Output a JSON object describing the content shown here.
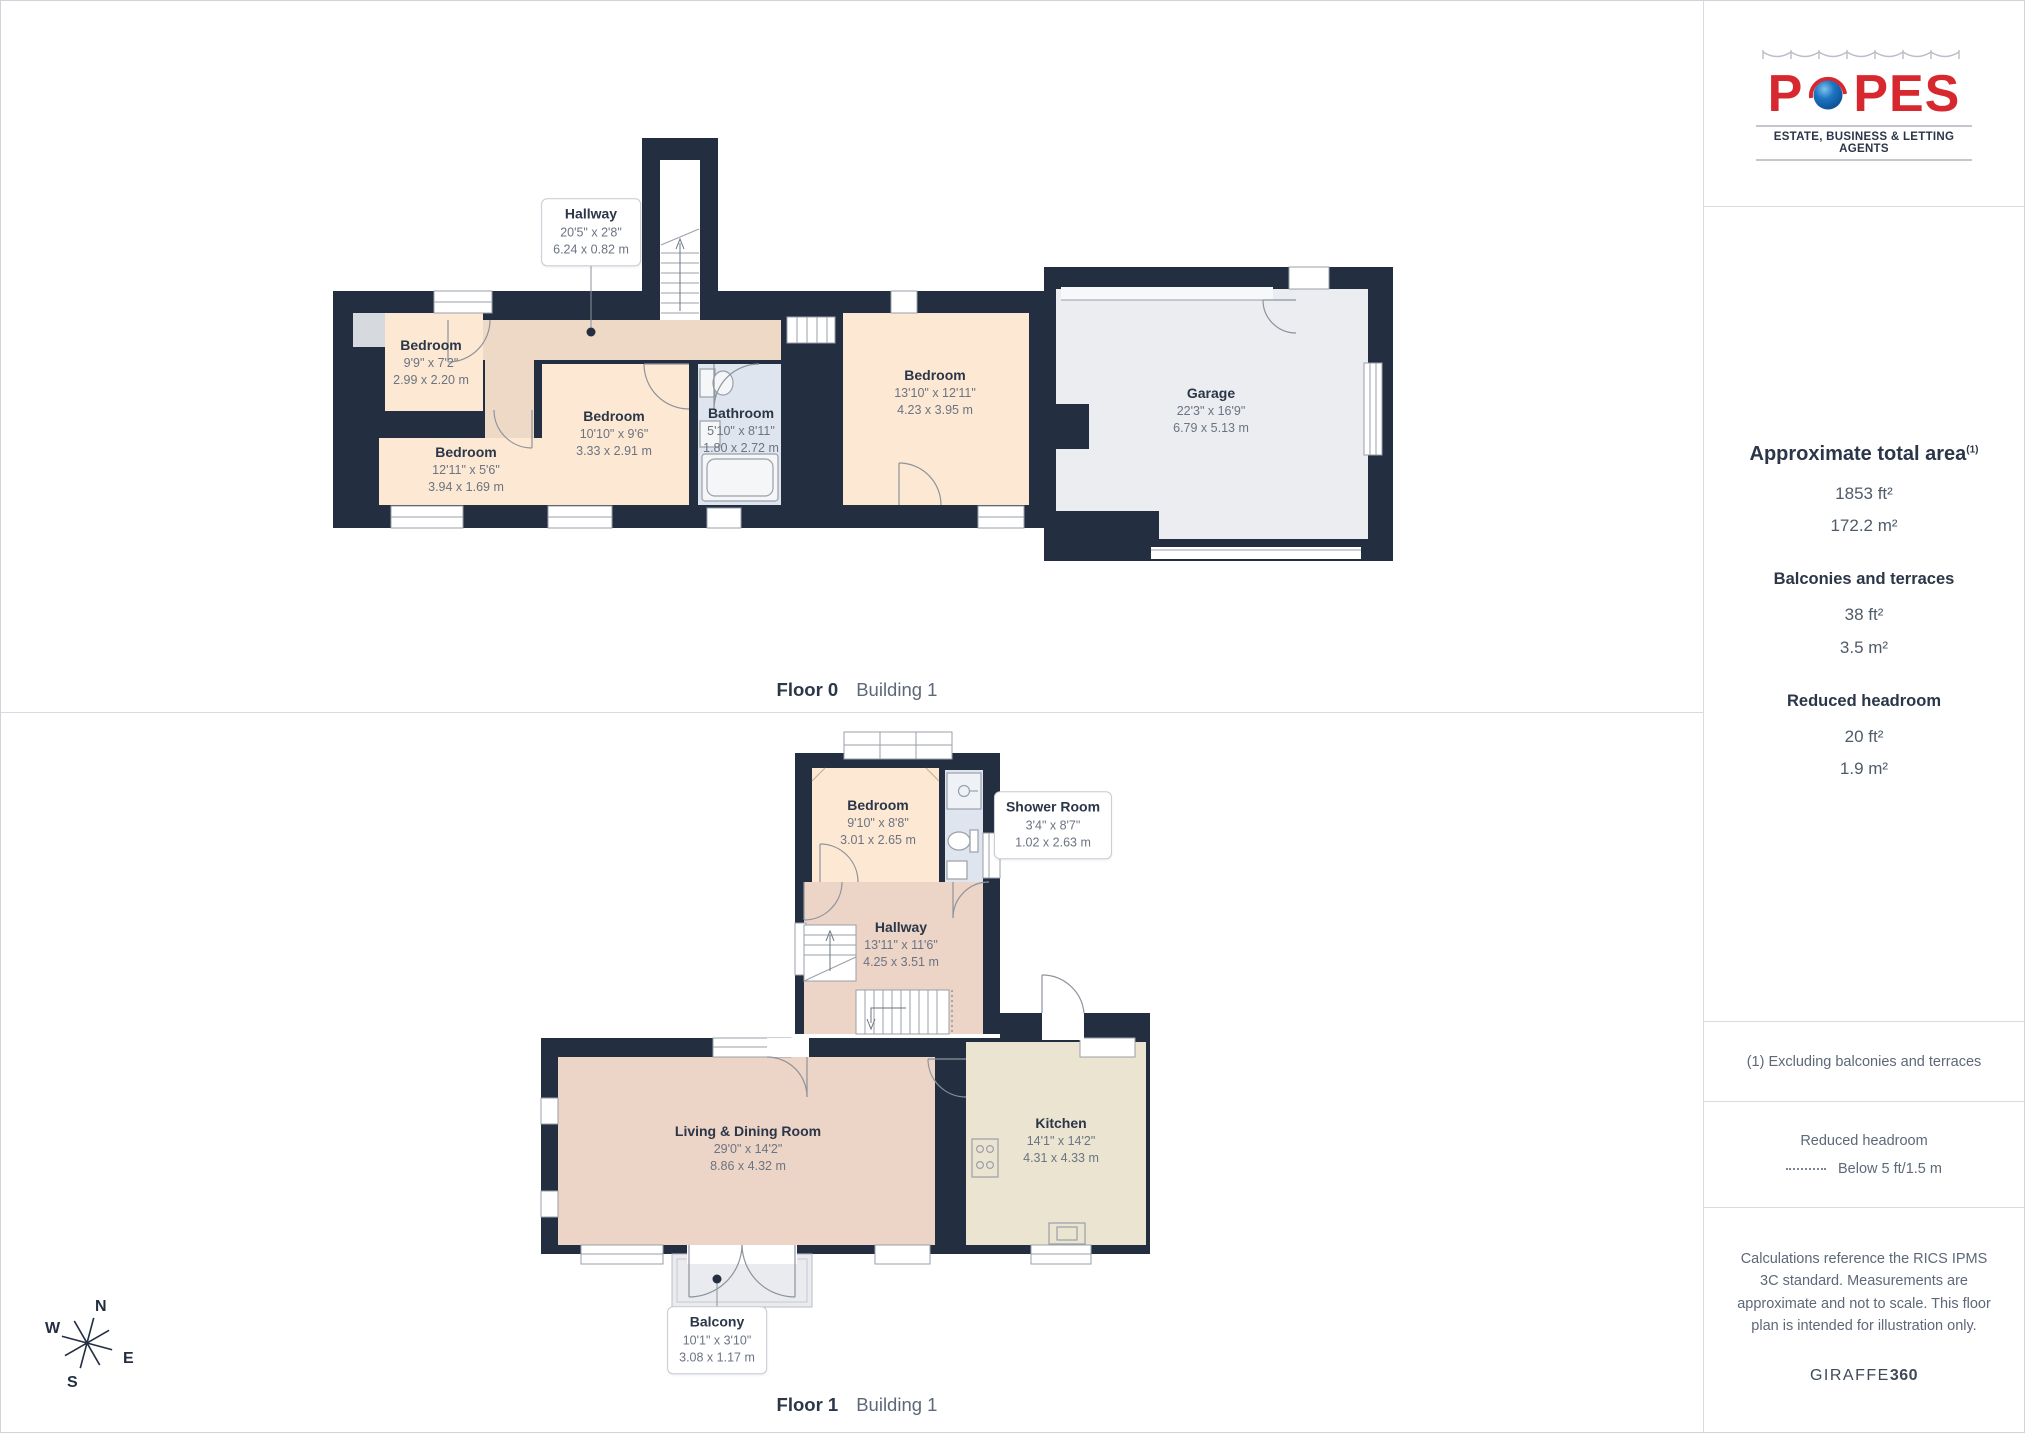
{
  "branding": {
    "logo_letters_before": "P",
    "logo_letters_after": "PES",
    "tagline": "ESTATE, BUSINESS & LETTING AGENTS"
  },
  "sidebar": {
    "total_area_title": "Approximate total area",
    "total_area_sup": "(1)",
    "total_area_ft": "1853 ft²",
    "total_area_m": "172.2 m²",
    "balconies_title": "Balconies and terraces",
    "balconies_ft": "38 ft²",
    "balconies_m": "3.5 m²",
    "headroom_title": "Reduced headroom",
    "headroom_ft": "20 ft²",
    "headroom_m": "1.9 m²",
    "footnote": "(1) Excluding balconies and terraces",
    "legend_title": "Reduced headroom",
    "legend_label": "Below 5 ft/1.5 m",
    "disclaimer": "Calculations reference the RICS IPMS 3C standard. Measurements are approximate and not to scale. This floor plan is intended for illustration only.",
    "brand_normal": "GIRAFFE",
    "brand_bold": "360"
  },
  "floor0": {
    "label": "Floor 0",
    "building": "Building 1",
    "rooms": [
      {
        "name": "Bedroom",
        "ft": "9'9\" x 7'2\"",
        "m": "2.99 x 2.20 m"
      },
      {
        "name": "Bedroom",
        "ft": "12'11\" x 5'6\"",
        "m": "3.94 x 1.69 m"
      },
      {
        "name": "Bedroom",
        "ft": "10'10\" x 9'6\"",
        "m": "3.33 x 2.91 m"
      },
      {
        "name": "Bathroom",
        "ft": "5'10\" x 8'11\"",
        "m": "1.80 x 2.72 m"
      },
      {
        "name": "Bedroom",
        "ft": "13'10\" x 12'11\"",
        "m": "4.23 x 3.95 m"
      },
      {
        "name": "Garage",
        "ft": "22'3\" x 16'9\"",
        "m": "6.79 x 5.13 m"
      }
    ],
    "callout": {
      "name": "Hallway",
      "ft": "20'5\" x 2'8\"",
      "m": "6.24 x 0.82 m"
    }
  },
  "floor1": {
    "label": "Floor 1",
    "building": "Building 1",
    "rooms": [
      {
        "name": "Bedroom",
        "ft": "9'10\" x 8'8\"",
        "m": "3.01 x 2.65 m"
      },
      {
        "name": "Hallway",
        "ft": "13'11\" x 11'6\"",
        "m": "4.25 x 3.51 m"
      },
      {
        "name": "Living & Dining Room",
        "ft": "29'0\" x 14'2\"",
        "m": "8.86 x 4.32 m"
      },
      {
        "name": "Kitchen",
        "ft": "14'1\" x 14'2\"",
        "m": "4.31 x 4.33 m"
      }
    ],
    "callouts": [
      {
        "name": "Shower Room",
        "ft": "3'4\" x 8'7\"",
        "m": "1.02 x 2.63 m"
      },
      {
        "name": "Balcony",
        "ft": "10'1\" x 3'10\"",
        "m": "3.08 x 1.17 m"
      }
    ]
  },
  "compass": {
    "n": "N",
    "e": "E",
    "s": "S",
    "w": "W"
  },
  "colors": {
    "wall": "#232f40",
    "room_peach": "#fce8d3",
    "hallway_tan": "#eed9c6",
    "pink": "#ecd4c6",
    "kitchen_cream": "#ebe4d0",
    "bath_blue": "#dfe5ee",
    "garage_gray": "#ebedf0",
    "balcony_gray": "#e9ebee",
    "logo_red": "#d7282f",
    "logo_blue": "#1d74c0"
  }
}
